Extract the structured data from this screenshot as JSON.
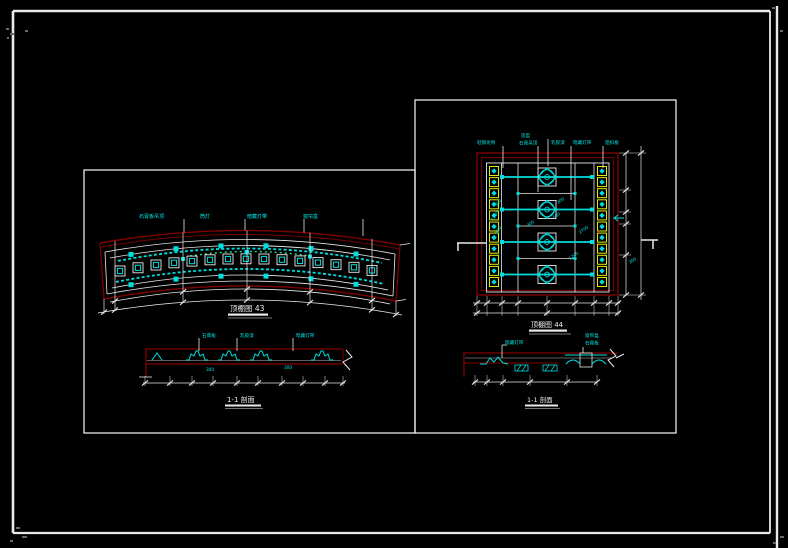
{
  "colors": {
    "background": "#000000",
    "frame": "#ededed",
    "outline_red": "#7f0000",
    "annotation_cyan": "#00e6e6",
    "grid_yellow": "#dfee00",
    "line_white": "#e9e9e9"
  },
  "left_view": {
    "plan": {
      "title": "顶棚图 43",
      "callouts": [
        "石膏板吊顶",
        "筒灯",
        "暗藏灯带",
        "窗帘盒"
      ]
    },
    "section": {
      "title": "1-1 剖面",
      "callouts": [
        "石膏板",
        "乳胶漆",
        "暗藏灯带"
      ],
      "dims": [
        "300",
        "300"
      ]
    }
  },
  "right_view": {
    "plan": {
      "title": "顶棚图 44",
      "callouts": [
        "轻钢龙骨",
        "造型",
        "石膏吊顶",
        "乳胶漆",
        "暗藏灯带",
        "铝扣板"
      ],
      "dims_left": [
        "300",
        "1200",
        "600"
      ],
      "dims_center": [
        "300",
        "600",
        "300",
        "2700",
        "1200"
      ],
      "dim_note": "300"
    },
    "section": {
      "title": "1-1 剖面",
      "callouts": [
        "暗藏灯带",
        "窗帘盒",
        "石膏板"
      ]
    }
  }
}
